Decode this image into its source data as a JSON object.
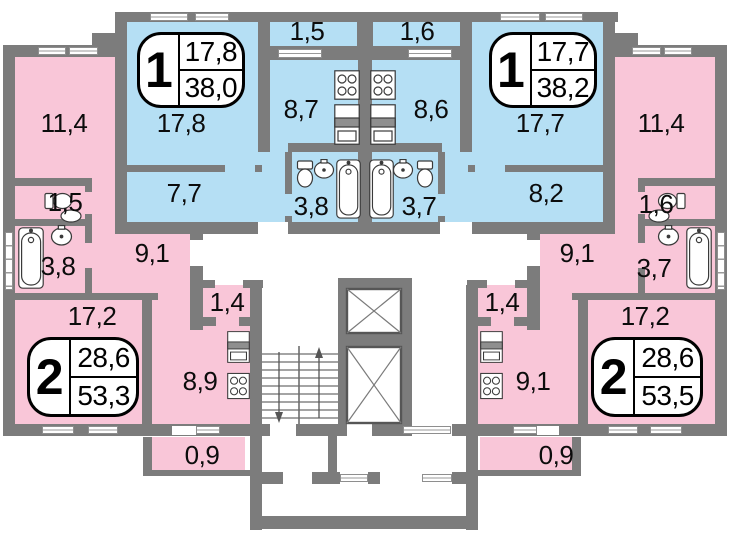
{
  "colors": {
    "one_room_fill": "#b5dff4",
    "two_room_fill": "#f9c6d8",
    "wall": "#7c7c7c",
    "label": "#0c0c0c"
  },
  "apartments": [
    {
      "kind": "one-room-left",
      "badge": {
        "number": "1",
        "living_area": "17,8",
        "total_area": "38,0"
      },
      "rooms": {
        "living": "17,8",
        "kitchen": "8,7",
        "hall": "7,7",
        "bath": "3,8",
        "balcony": "1,5"
      }
    },
    {
      "kind": "one-room-right",
      "badge": {
        "number": "1",
        "living_area": "17,7",
        "total_area": "38,2"
      },
      "rooms": {
        "living": "17,7",
        "kitchen": "8,6",
        "hall": "8,2",
        "bath": "3,7",
        "balcony": "1,6"
      }
    },
    {
      "kind": "two-room-left",
      "badge": {
        "number": "2",
        "living_area": "28,6",
        "total_area": "53,3"
      },
      "rooms": {
        "bedroom": "11,4",
        "living": "17,2",
        "wc": "1,5",
        "bath": "3,8",
        "hall": "9,1",
        "entry": "1,4",
        "kitchen": "8,9",
        "balcony": "0,9"
      }
    },
    {
      "kind": "two-room-right",
      "badge": {
        "number": "2",
        "living_area": "28,6",
        "total_area": "53,5"
      },
      "rooms": {
        "bedroom": "11,4",
        "living": "17,2",
        "wc": "1,6",
        "bath": "3,7",
        "hall": "9,1",
        "entry": "1,4",
        "kitchen": "9,1",
        "balcony": "0,9"
      }
    }
  ]
}
